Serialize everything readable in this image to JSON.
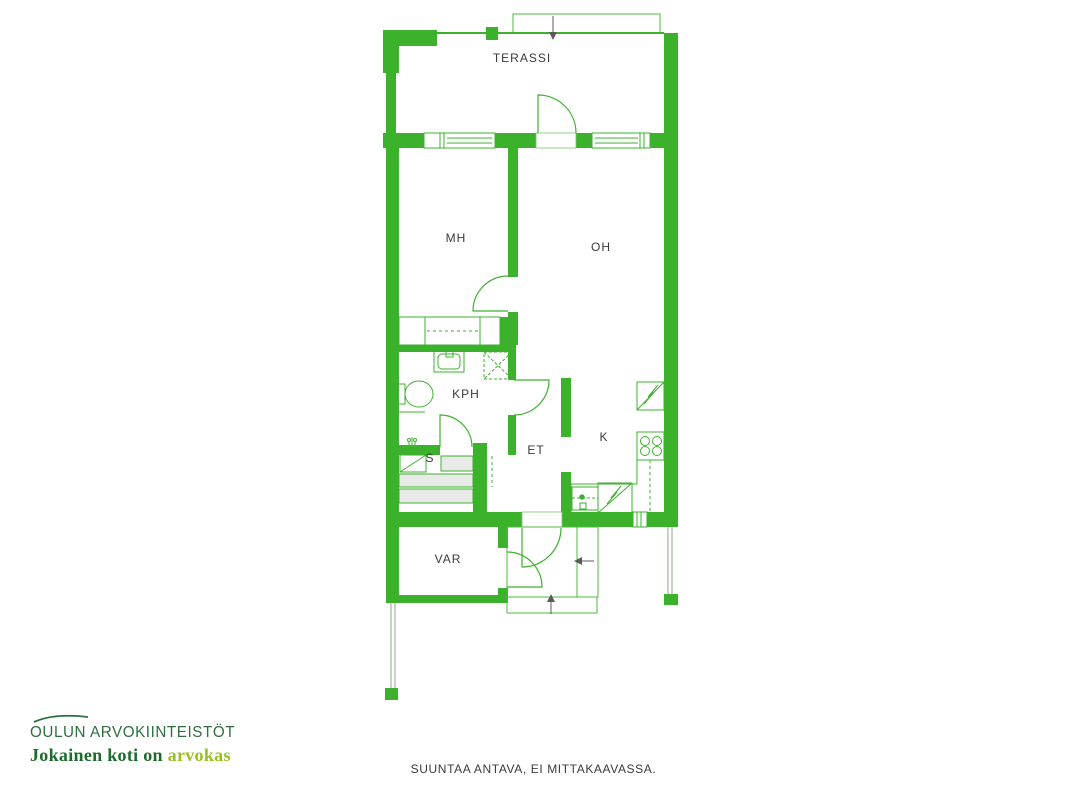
{
  "floor_plan": {
    "rooms": {
      "terassi": "TERASSI",
      "mh": "MH",
      "oh": "OH",
      "kph": "KPH",
      "et": "ET",
      "k": "K",
      "s": "S",
      "var": "VAR"
    }
  },
  "branding": {
    "company": "OULUN ARVOKIINTEISTÖT",
    "tagline_prefix": "Jokainen koti on",
    "tagline_accent": "arvokas"
  },
  "footer": {
    "disclaimer": "SUUNTAA ANTAVA, EI MITTAKAAVASSA."
  },
  "colors": {
    "wall_green": "#3CB12C",
    "thin_line_green": "#4CB83C",
    "bench_gray": "#E9E9E9",
    "label_gray": "#3A3A3A",
    "arrow_gray": "#5A5A5A",
    "fence_gray": "#8FA98B",
    "logo_green": "#2E6F40",
    "tagline_green": "#1C6B2E",
    "tagline_accent_green": "#97C11F"
  }
}
